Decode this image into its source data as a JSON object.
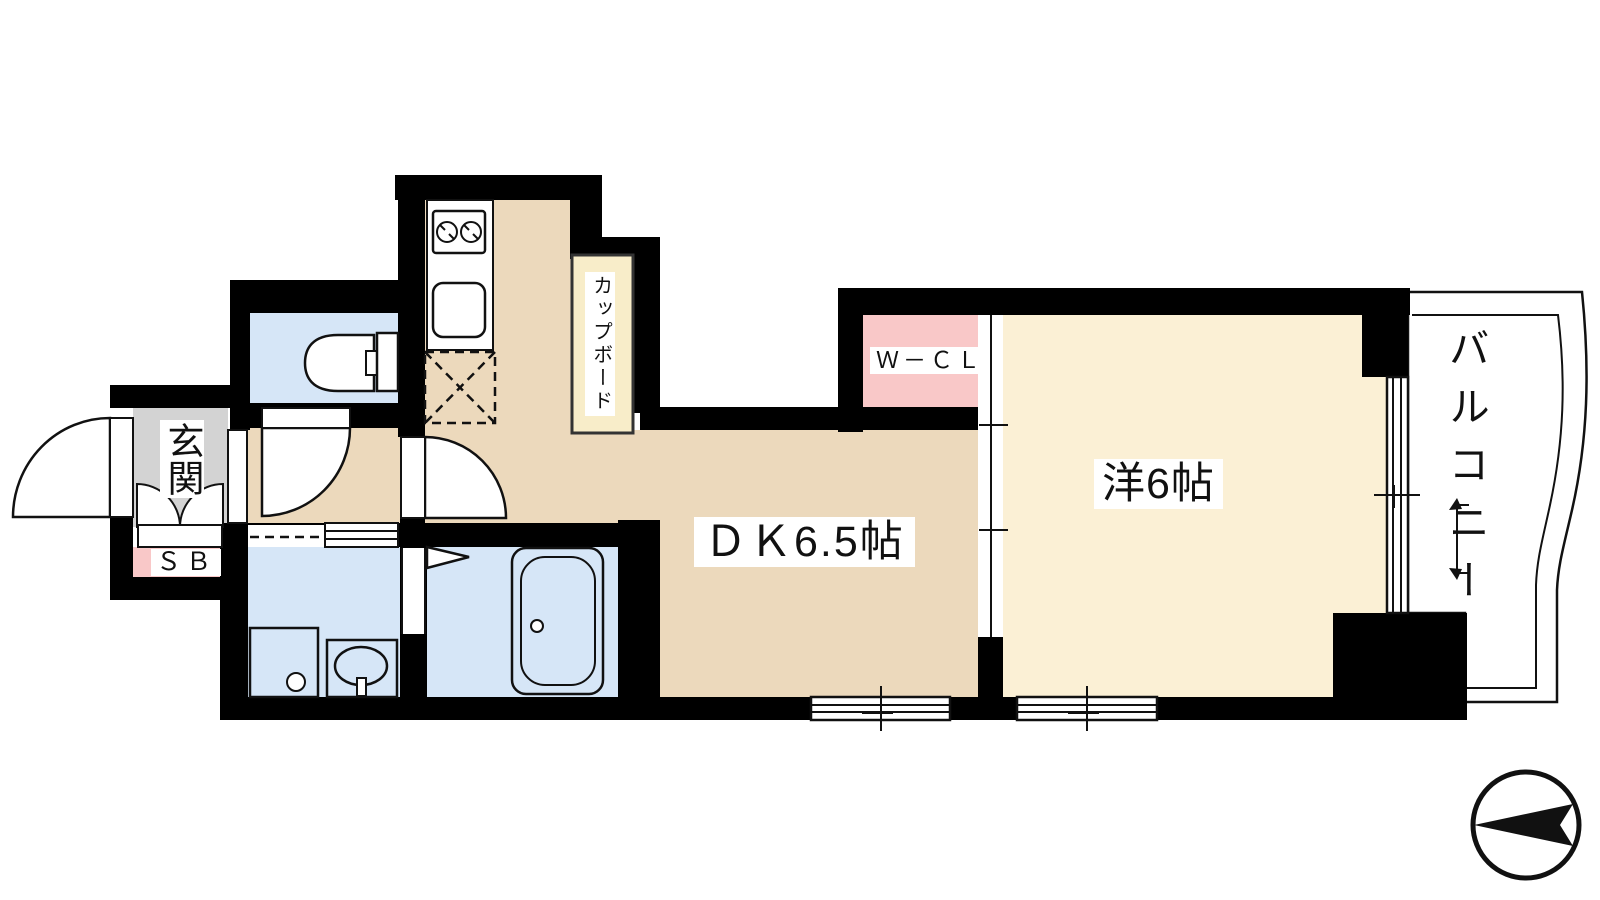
{
  "title": "apartment-floor-plan",
  "colors": {
    "wall": "#000000",
    "line": "#111111",
    "floor_dk": "#ECD9BC",
    "floor_room": "#FBF0D5",
    "floor_wet": "#D6E6F7",
    "floor_genkan": "#D3D3D3",
    "closet_pink": "#F9C8C8",
    "cupboard_cream": "#F8EDC9",
    "label_bg": "#FFFFFF",
    "bg": "#FFFFFF",
    "text": "#111111"
  },
  "rooms": {
    "genkan": {
      "label": "玄関"
    },
    "shoe_box": {
      "label": "ＳＢ"
    },
    "cupboard": {
      "label": "カップボード"
    },
    "dining_kitchen": {
      "label": "ＤＫ6.5帖"
    },
    "walk_in_closet": {
      "label": "Ｗ－ＣＬ"
    },
    "western_room": {
      "label": "洋6帖"
    },
    "balcony": {
      "label": "バルコニー"
    }
  },
  "compass": {
    "arrow_direction": "left"
  }
}
